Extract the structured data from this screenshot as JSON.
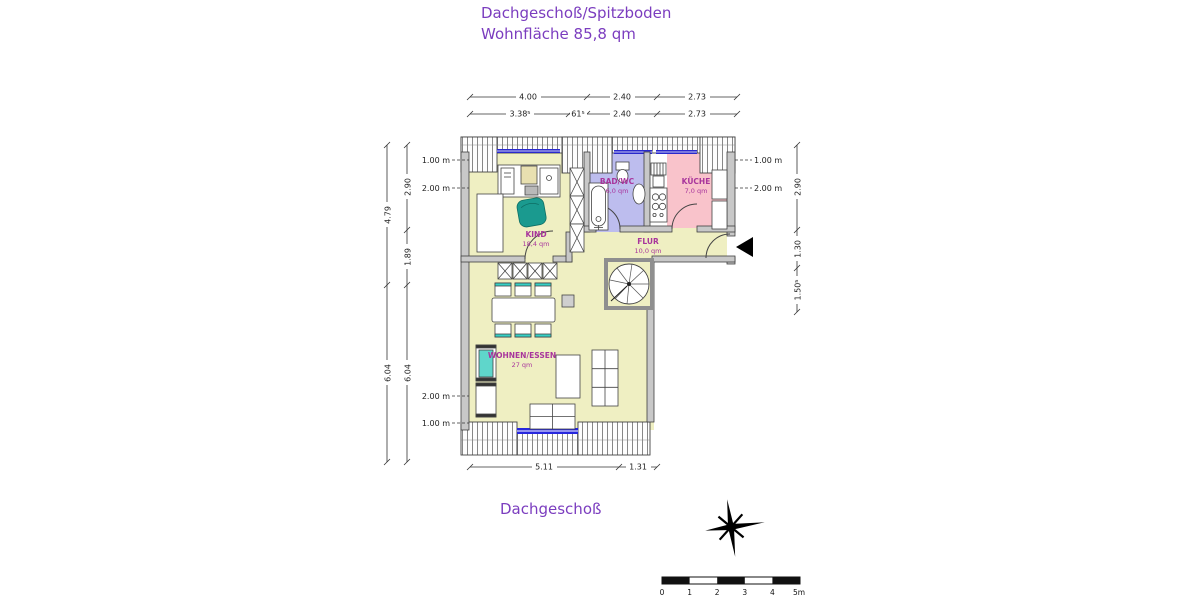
{
  "title": {
    "line1": "Dachgeschoß/Spitzboden",
    "line2": "Wohnfläche 85,8 qm"
  },
  "plan_label": "Dachgeschoß",
  "rooms": {
    "kind": {
      "name": "KIND",
      "area": "18,4 qm"
    },
    "bad": {
      "name": "BAD/WC",
      "area": "6,0 qm"
    },
    "kueche": {
      "name": "KÜCHE",
      "area": "7,0 qm"
    },
    "flur": {
      "name": "FLUR",
      "area": "10,0 qm"
    },
    "wohnen": {
      "name": "WOHNEN/ESSEN",
      "area": "27 qm"
    }
  },
  "dimensions": {
    "top_row1": [
      "4.00",
      "2.40",
      "2.73"
    ],
    "top_row2": [
      "3.38⁵",
      "61⁵",
      "2.40",
      "2.73"
    ],
    "bottom": [
      "5.11",
      "1.31"
    ],
    "left_outer": [
      "4.79",
      "6.04"
    ],
    "left_inner": [
      "2.90",
      "1.89",
      "6.04"
    ],
    "right_side": [
      "2.90",
      "1.30",
      "1.50⁵"
    ],
    "height_marks_left": [
      "1.00 m",
      "2.00 m",
      "2.00 m",
      "1.00 m"
    ],
    "height_marks_right": [
      "1.00 m",
      "2.00 m"
    ]
  },
  "scale_bar": {
    "tick_labels": [
      "0",
      "1",
      "2",
      "3",
      "4",
      "5m"
    ]
  },
  "colors": {
    "title_text": "#7b3dbf",
    "room_label": "#a8359c",
    "living_fill": "#efefc2",
    "bath_fill": "#bdbdee",
    "kitchen_fill": "#f9c3cb",
    "wall_fill": "#c8c8c8",
    "window_blue": "#2929cc",
    "accent_cyan": "#35d0c5",
    "north_arrow": "#000000"
  }
}
